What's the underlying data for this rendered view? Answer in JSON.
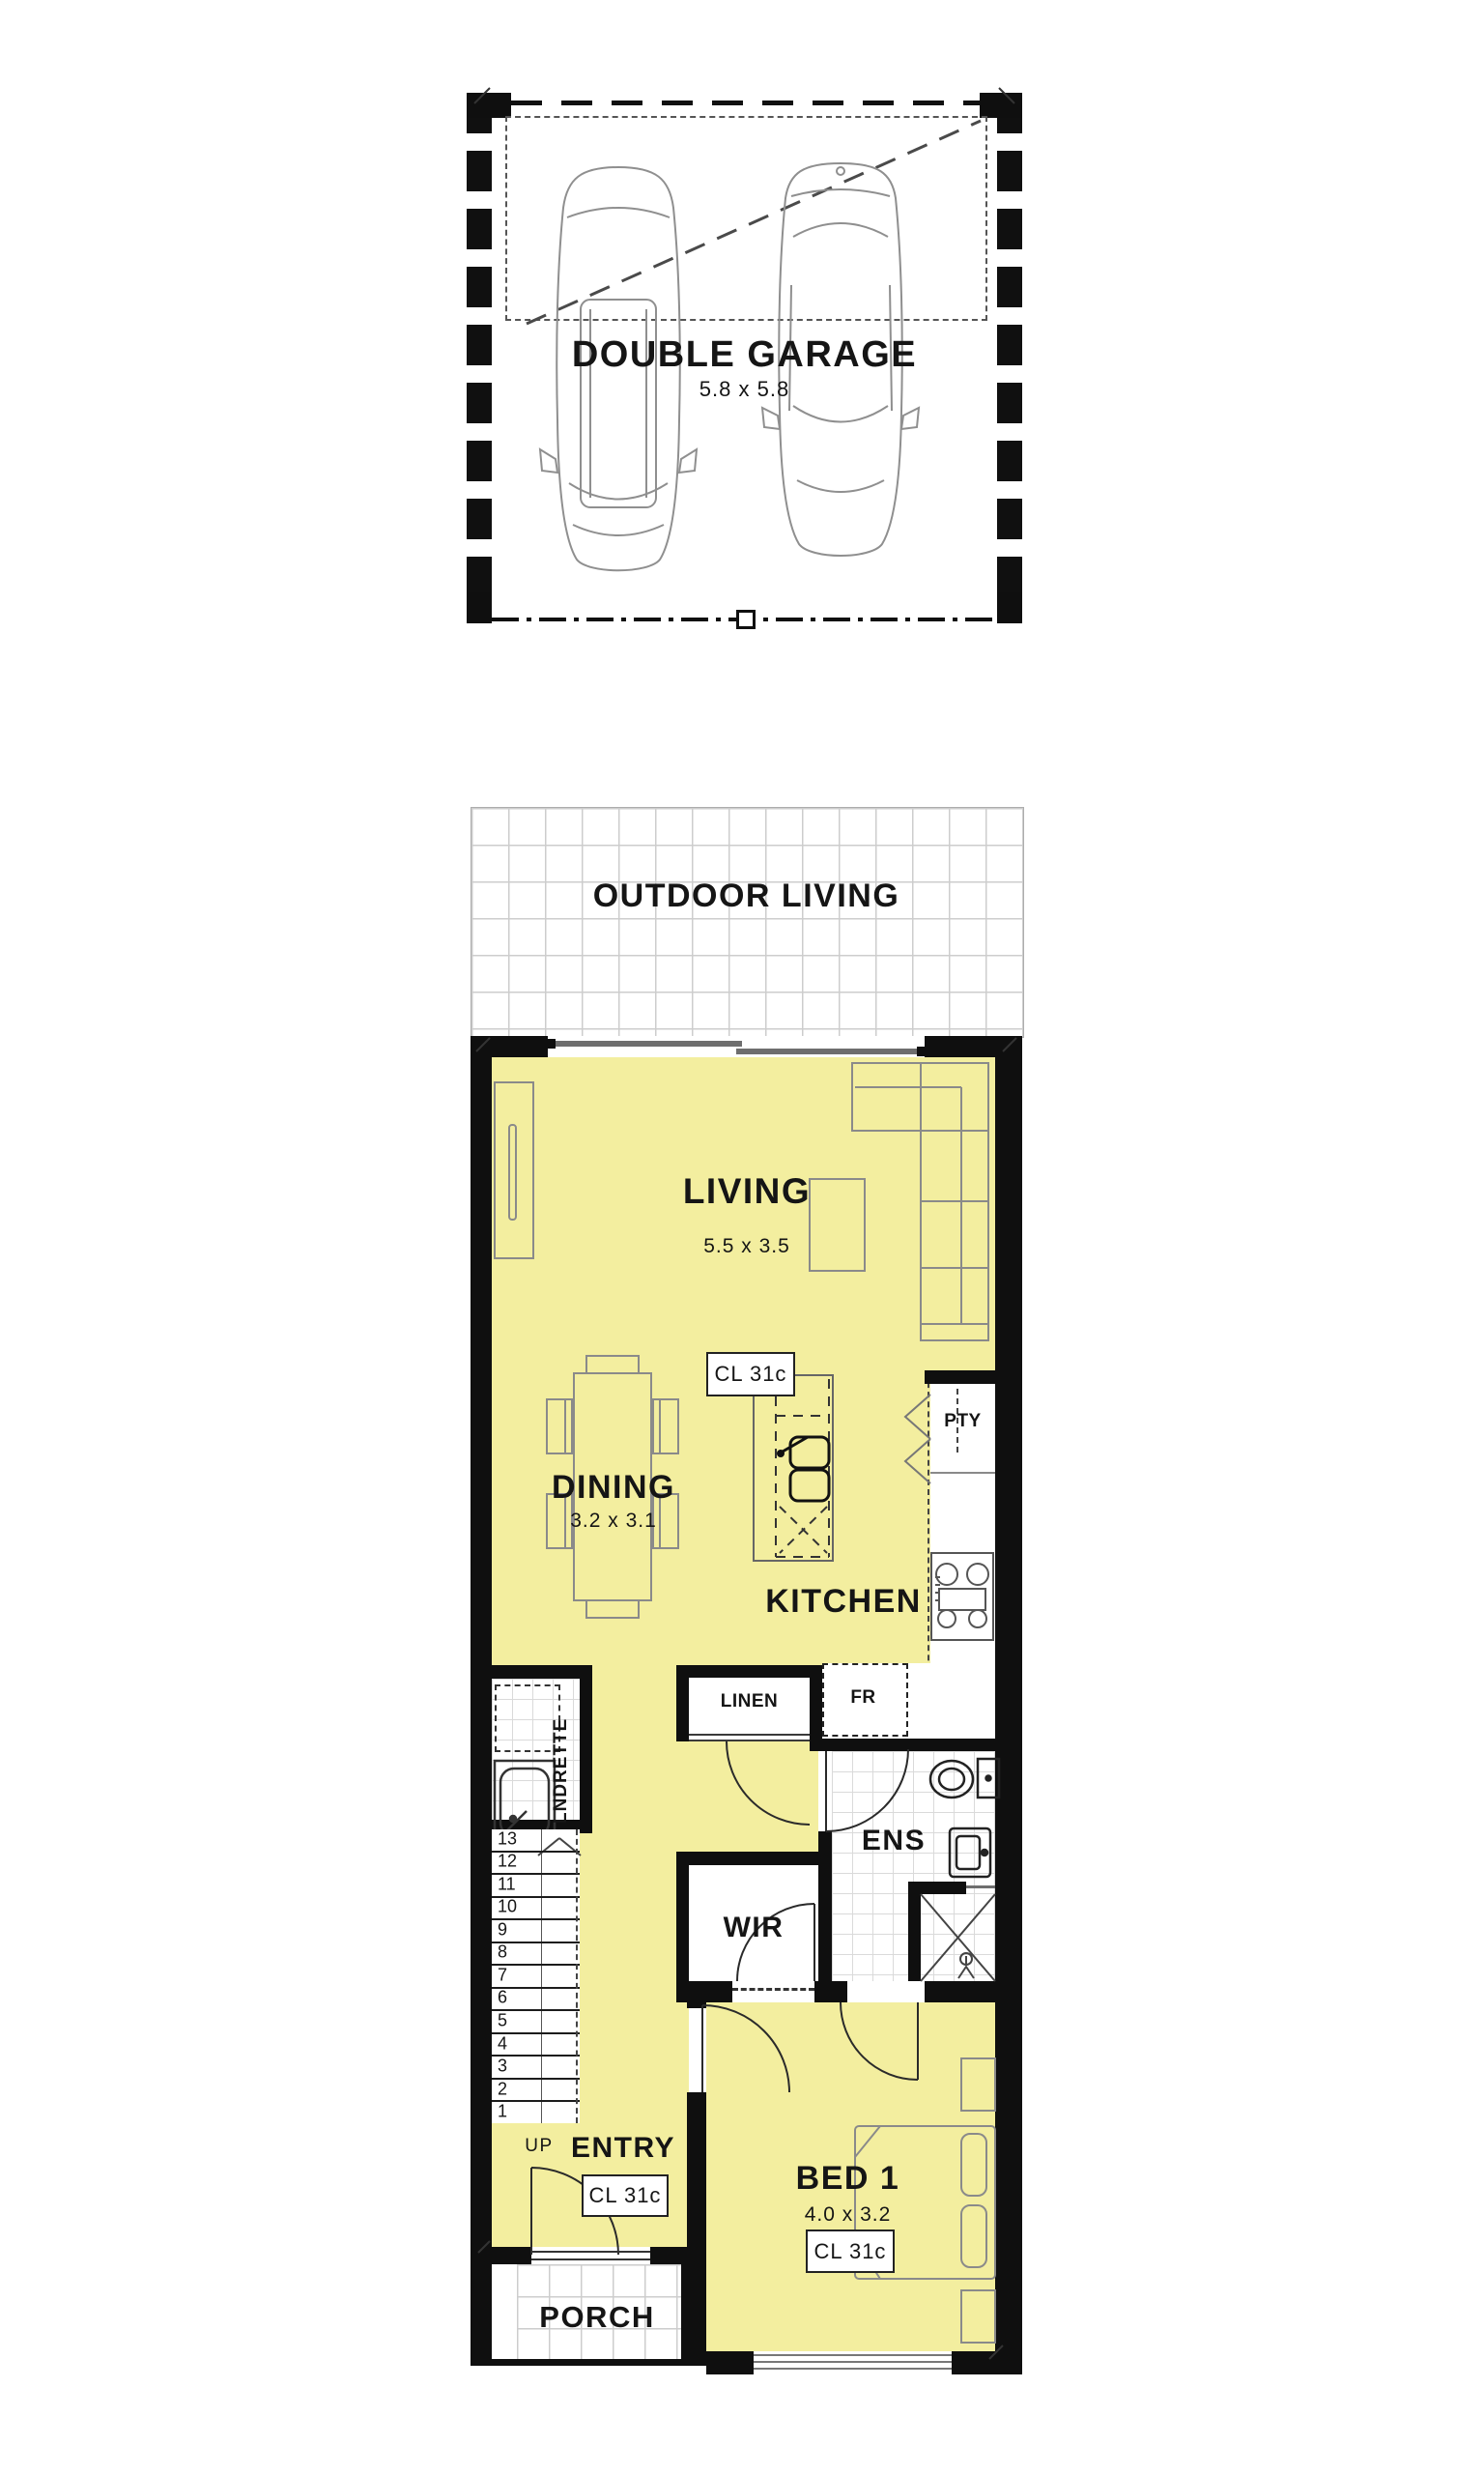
{
  "plan": {
    "colors": {
      "floor_yellow": "#F3EE9F",
      "wall_black": "#0F0F0F",
      "furniture_gray": "#8E8E8E",
      "tile_gray": "#CDCDCD"
    },
    "garage": {
      "title": "DOUBLE GARAGE",
      "dims": "5.8 x 5.8"
    },
    "outdoor_living": {
      "label": "OUTDOOR LIVING"
    },
    "living": {
      "label": "LIVING",
      "dims": "5.5 x 3.5",
      "ceiling_label": "CL 31c"
    },
    "dining": {
      "label": "DINING",
      "dims": "3.2 x 3.1"
    },
    "kitchen": {
      "label": "KITCHEN",
      "pantry_label": "PTY",
      "fridge_label": "FR"
    },
    "linen": {
      "label": "LINEN"
    },
    "laundry": {
      "label": "LNDRETTE"
    },
    "ensuite": {
      "label": "ENS"
    },
    "wir": {
      "label": "WIR"
    },
    "stairs": {
      "up_label": "UP",
      "steps": [
        "1",
        "2",
        "3",
        "4",
        "5",
        "6",
        "7",
        "8",
        "9",
        "10",
        "11",
        "12",
        "13"
      ]
    },
    "entry": {
      "label": "ENTRY",
      "ceiling_label": "CL 31c"
    },
    "bed1": {
      "label": "BED 1",
      "dims": "4.0 x 3.2",
      "ceiling_label": "CL 31c"
    },
    "porch": {
      "label": "PORCH"
    }
  }
}
